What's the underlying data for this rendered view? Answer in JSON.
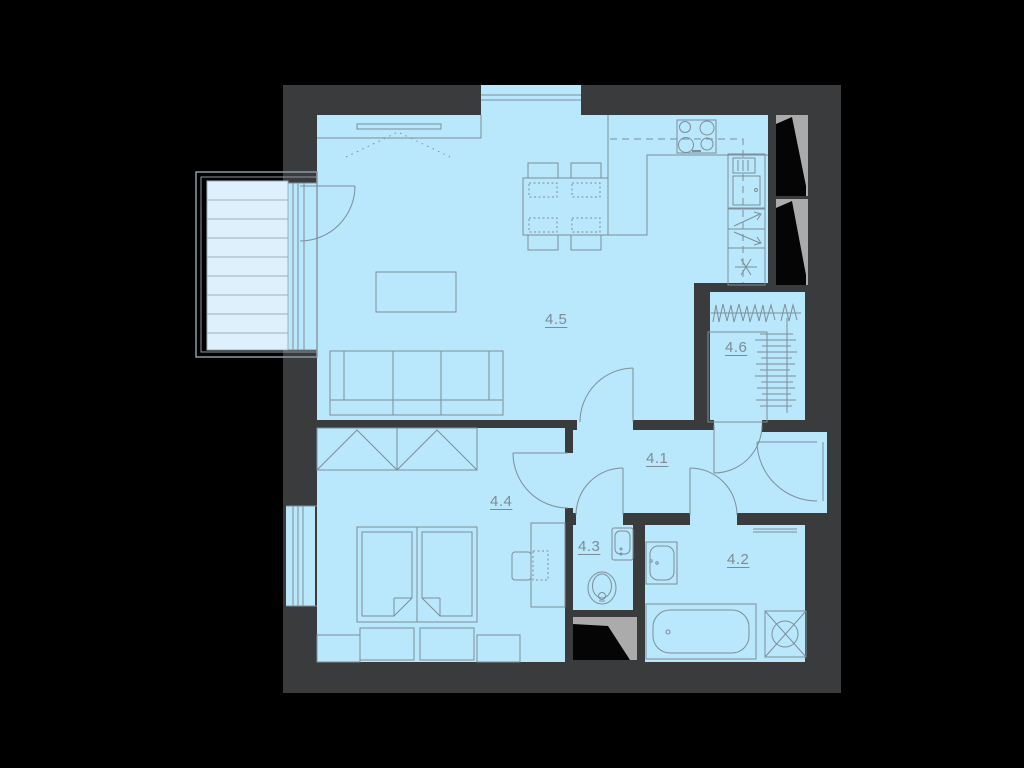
{
  "floorplan": {
    "colors": {
      "background": "#000000",
      "wall": "#393b3d",
      "room_fill": "#b9e7fb",
      "balcony_fill": "#def0fc",
      "line": "#7d8f9a",
      "label": "#7c8c96",
      "shaft_gray": "#ababab",
      "shaft_black": "#050505"
    },
    "rooms": [
      {
        "key": "hallway",
        "label": "4.1"
      },
      {
        "key": "bathroom",
        "label": "4.2"
      },
      {
        "key": "wc",
        "label": "4.3"
      },
      {
        "key": "bedroom",
        "label": "4.4"
      },
      {
        "key": "living-kitchen",
        "label": "4.5"
      },
      {
        "key": "closet",
        "label": "4.6"
      }
    ],
    "symbols": [
      "balcony-deck",
      "balcony-door",
      "window",
      "sofa",
      "coffee-table",
      "dining-table",
      "dining-chair",
      "kitchen-counter",
      "stove",
      "fridge",
      "kitchen-cabinet-arrows",
      "water-heater",
      "hanging-rail",
      "wardrobe",
      "double-bed",
      "bed-bench",
      "desk",
      "desk-chair",
      "toilet",
      "wc-sink",
      "washbasin",
      "bathtub",
      "washing-machine",
      "towel-rail",
      "entry-door",
      "ventilation-shaft"
    ]
  }
}
